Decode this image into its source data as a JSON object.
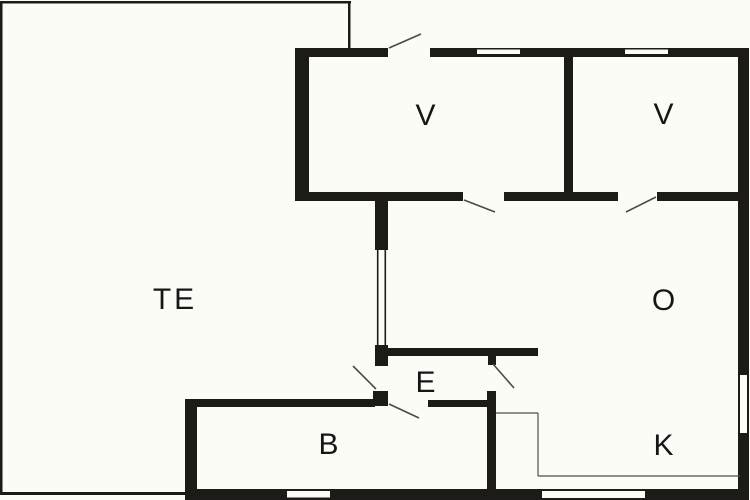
{
  "title": "apartment-floor-plan",
  "colors": {
    "background": "#fcfcf6",
    "wall": "#1d1b18",
    "window_fill": "#fcfcf6",
    "door_swing": "#4b4b44",
    "zone_line": "#4e4e47",
    "label": "#161616"
  },
  "rooms": [
    {
      "id": "te",
      "label": "TE",
      "x": 175,
      "y": 300
    },
    {
      "id": "v1",
      "label": "V",
      "x": 427,
      "y": 116
    },
    {
      "id": "v2",
      "label": "V",
      "x": 665,
      "y": 115
    },
    {
      "id": "o",
      "label": "O",
      "x": 665,
      "y": 301
    },
    {
      "id": "e",
      "label": "E",
      "x": 427,
      "y": 383
    },
    {
      "id": "b",
      "label": "B",
      "x": 330,
      "y": 445
    },
    {
      "id": "k",
      "label": "K",
      "x": 665,
      "y": 446
    }
  ],
  "geometry": {
    "outline_rects": [
      {
        "name": "te-outline-top",
        "x": 2,
        "y": 1,
        "w": 349,
        "h": 2.5
      },
      {
        "name": "te-outline-right",
        "x": 348,
        "y": 1,
        "w": 2.5,
        "h": 49
      },
      {
        "name": "te-outline-left",
        "x": 0,
        "y": 1,
        "w": 2.5,
        "h": 494
      },
      {
        "name": "te-outline-bottom",
        "x": 0,
        "y": 492,
        "w": 188,
        "h": 3
      }
    ],
    "walls": [
      {
        "name": "north-wall-west",
        "x": 295,
        "y": 48,
        "w": 93,
        "h": 9
      },
      {
        "name": "north-wall-east",
        "x": 430,
        "y": 48,
        "w": 319,
        "h": 9
      },
      {
        "name": "east-wall",
        "x": 738,
        "y": 48,
        "w": 11,
        "h": 452
      },
      {
        "name": "west-house-wall",
        "x": 295,
        "y": 48,
        "w": 14,
        "h": 152
      },
      {
        "name": "v-south-wall-1",
        "x": 295,
        "y": 192,
        "w": 168,
        "h": 9
      },
      {
        "name": "v-south-wall-2",
        "x": 504,
        "y": 192,
        "w": 114,
        "h": 9
      },
      {
        "name": "v-south-wall-3",
        "x": 657,
        "y": 192,
        "w": 92,
        "h": 9
      },
      {
        "name": "v-divider-wall",
        "x": 564,
        "y": 53,
        "w": 9,
        "h": 148
      },
      {
        "name": "hall-wall-upper",
        "x": 375,
        "y": 194,
        "w": 13,
        "h": 57
      },
      {
        "name": "hall-wall-lower",
        "x": 375,
        "y": 345,
        "w": 13,
        "h": 21
      },
      {
        "name": "entry-door-post",
        "x": 373,
        "y": 391,
        "w": 15,
        "h": 15
      },
      {
        "name": "e-north-wall",
        "x": 388,
        "y": 348,
        "w": 150,
        "h": 8
      },
      {
        "name": "eo-door-post",
        "x": 488,
        "y": 355,
        "w": 8,
        "h": 10
      },
      {
        "name": "b-north-wall-west",
        "x": 185,
        "y": 399,
        "w": 190,
        "h": 8
      },
      {
        "name": "b-north-wall-east",
        "x": 428,
        "y": 400,
        "w": 62,
        "h": 7
      },
      {
        "name": "b-west-wall",
        "x": 185,
        "y": 399,
        "w": 12,
        "h": 101
      },
      {
        "name": "k-west-wall",
        "x": 487,
        "y": 391,
        "w": 9,
        "h": 102
      },
      {
        "name": "south-wall",
        "x": 185,
        "y": 489,
        "w": 564,
        "h": 11
      }
    ],
    "windows": [
      {
        "name": "v1-window",
        "x": 477,
        "y": 49.5,
        "w": 43,
        "h": 4.5
      },
      {
        "name": "v2-window",
        "x": 625,
        "y": 49.5,
        "w": 43,
        "h": 4.5
      },
      {
        "name": "hall-window",
        "x": 375,
        "y": 250,
        "w": 13,
        "h": 95
      },
      {
        "name": "o-east-window",
        "x": 740,
        "y": 375,
        "w": 7,
        "h": 58
      },
      {
        "name": "b-south-window",
        "x": 287,
        "y": 491,
        "w": 43,
        "h": 6.5
      },
      {
        "name": "k-south-window",
        "x": 542,
        "y": 491,
        "w": 103,
        "h": 7
      }
    ],
    "window_bars": [
      {
        "name": "hall-window-bar-outer",
        "x1": 377.7,
        "y1": 250,
        "x2": 377.7,
        "y2": 345
      },
      {
        "name": "hall-window-bar-inner",
        "x1": 385.3,
        "y1": 250,
        "x2": 385.3,
        "y2": 345
      }
    ],
    "door_swings": [
      {
        "name": "north-door-swing",
        "x1": 389,
        "y1": 48,
        "x2": 421,
        "y2": 34
      },
      {
        "name": "v1-door-swing",
        "x1": 464,
        "y1": 200,
        "x2": 495,
        "y2": 212
      },
      {
        "name": "v2-door-swing",
        "x1": 656,
        "y1": 197,
        "x2": 626,
        "y2": 212
      },
      {
        "name": "te-entry-door-swing",
        "x1": 376,
        "y1": 389,
        "x2": 353,
        "y2": 366
      },
      {
        "name": "eo-door-swing",
        "x1": 493,
        "y1": 364,
        "x2": 514,
        "y2": 388
      },
      {
        "name": "b-door-swing",
        "x1": 389,
        "y1": 404,
        "x2": 419,
        "y2": 418
      }
    ],
    "zone_lines": [
      {
        "name": "k-zone-line-top",
        "x1": 496,
        "y1": 413,
        "x2": 538,
        "y2": 413
      },
      {
        "name": "k-zone-line-left",
        "x1": 538,
        "y1": 413,
        "x2": 538,
        "y2": 476
      },
      {
        "name": "k-zone-line-bottom",
        "x1": 538,
        "y1": 476,
        "x2": 740,
        "y2": 476
      }
    ]
  }
}
